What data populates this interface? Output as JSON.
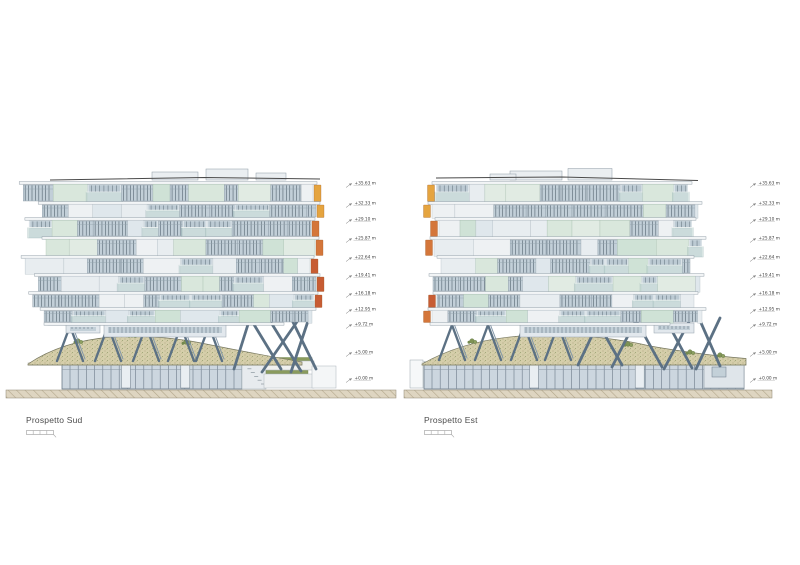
{
  "sheet": {
    "background": "#ffffff"
  },
  "levels": [
    "+35.63 m",
    "+32.33 m",
    "+29.10 m",
    "+25.87 m",
    "+22.64 m",
    "+19.41 m",
    "+16.18 m",
    "+12.95 m",
    "+9.72 m",
    "+5.00 m",
    "+0.00 m"
  ],
  "drawings": [
    {
      "id": "sud",
      "label": "Prospetto Sud",
      "accent_side": "right"
    },
    {
      "id": "est",
      "label": "Prospetto Est",
      "accent_side": "left"
    }
  ],
  "colors": {
    "accent_amber": "#e5a43f",
    "accent_orange": "#d4763a",
    "accent_terracotta": "#c75c33",
    "strut_steel": "#5c7184",
    "glass": "#c2cfd8",
    "mullion": "#53636f",
    "slab": "#f2f5f6",
    "mint_panel": "#d9e7dc",
    "balcony_glass": "#bed5d1",
    "green_roof": "#d5ceaa",
    "vegetation": "#7f9355",
    "ground_hatch": "#ded5c1",
    "annotation_text": "#3f3f3f"
  }
}
